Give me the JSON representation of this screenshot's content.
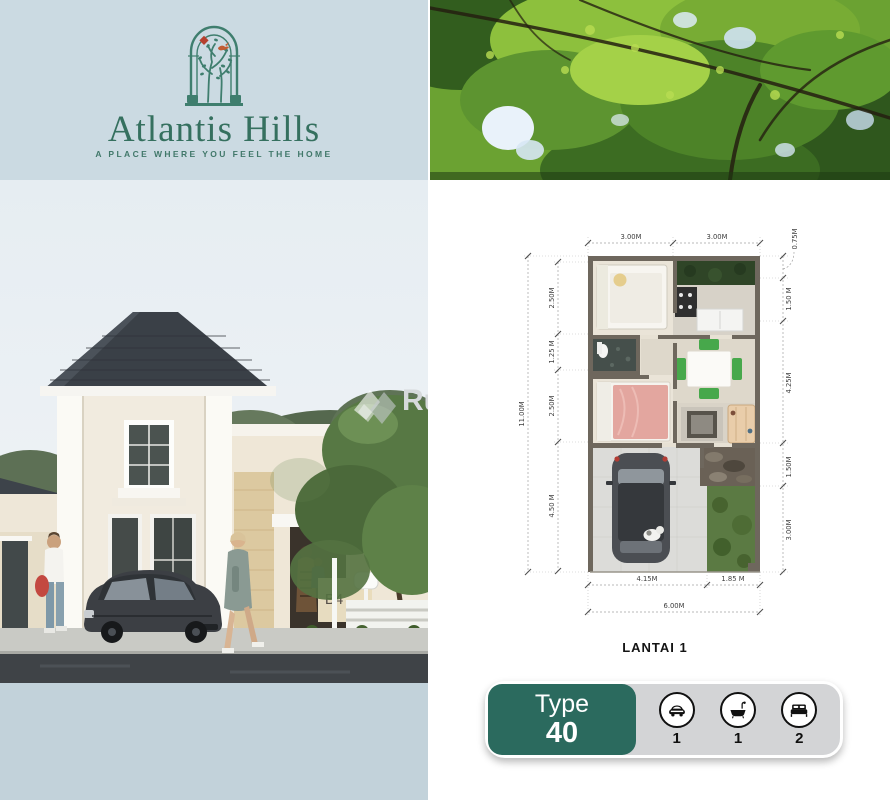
{
  "brand": {
    "name": "Atlantis Hills",
    "tagline": "A PLACE WHERE YOU FEEL THE HOME"
  },
  "watermark": {
    "text": "Rumaindo"
  },
  "exterior": {
    "house_number": "B4"
  },
  "floor_plan": {
    "title": "LANTAI 1",
    "dims_top": [
      "3.00M",
      "3.00M"
    ],
    "dim_left_total": "11.00M",
    "dims_left": [
      "2.50M",
      "1.25 M",
      "2.50M",
      "4.50 M"
    ],
    "dims_right": [
      "0.75M",
      "1.50 M",
      "4.25M",
      "1.50M",
      "3.00M"
    ],
    "dims_bottom": [
      "4.15M",
      "1.85 M"
    ],
    "dim_bottom_total": "6.00M"
  },
  "type_badge": {
    "label": "Type",
    "value": "40",
    "features": [
      {
        "icon": "car-icon",
        "count": "1"
      },
      {
        "icon": "bathtub-icon",
        "count": "1"
      },
      {
        "icon": "bed-icon",
        "count": "2"
      }
    ]
  },
  "colors": {
    "brand_teal": "#35705f",
    "badge_teal": "#2b6a5e",
    "panel_blue": "#cbdae2",
    "footer_blue": "#c2d2da",
    "logo_accent_red": "#b5402e"
  }
}
